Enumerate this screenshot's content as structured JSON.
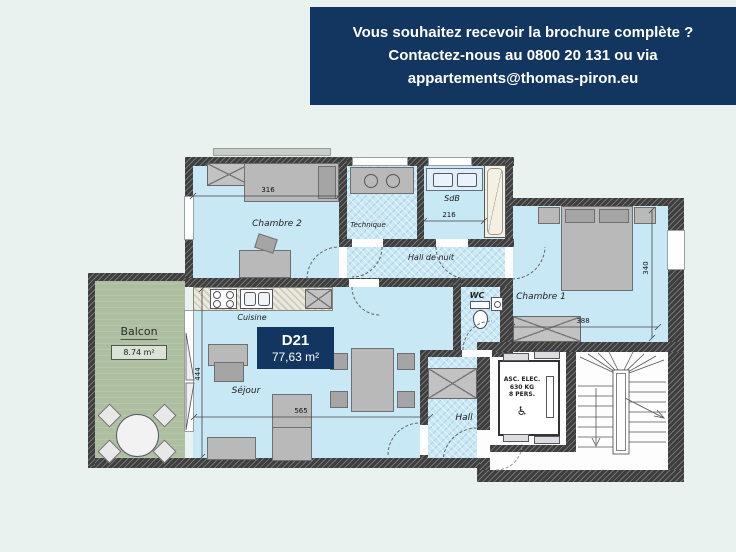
{
  "banner": {
    "line1": "Vous souhaitez recevoir la brochure complète ?",
    "line2": "Contactez-nous au 0800 20 131 ou via",
    "line3": "appartements@thomas-piron.eu"
  },
  "unit": {
    "code": "D21",
    "area": "77,63 m²"
  },
  "rooms": {
    "chambre2": {
      "label": "Chambre 2"
    },
    "technique": {
      "label": "Technique"
    },
    "sdb": {
      "label": "SdB"
    },
    "hall_de_nuit": {
      "label": "Hall de nuit"
    },
    "chambre1": {
      "label": "Chambre 1"
    },
    "wc": {
      "label": "WC"
    },
    "cuisine": {
      "label": "Cuisine"
    },
    "sejour": {
      "label": "Séjour"
    },
    "hall": {
      "label": "Hall"
    },
    "balcon": {
      "label": "Balcon",
      "area": "8.74 m²"
    }
  },
  "dimensions": {
    "chambre2_width": "316",
    "sdb_width": "216",
    "chambre1_depth": "340",
    "chambre1_width": "388",
    "sejour_depth": "444",
    "sejour_width": "565"
  },
  "elevator": {
    "line1": "ASC. ELEC.",
    "line2": "630 KG",
    "line3": "8 PERS.",
    "wheelchair_icon": "♿"
  },
  "colors": {
    "banner_bg": "#12365f",
    "room_fill": "#c9e8f6",
    "balcony_fill": "#adbfa0",
    "background": "#e9f2ef",
    "wall": "#3e3e3e"
  }
}
